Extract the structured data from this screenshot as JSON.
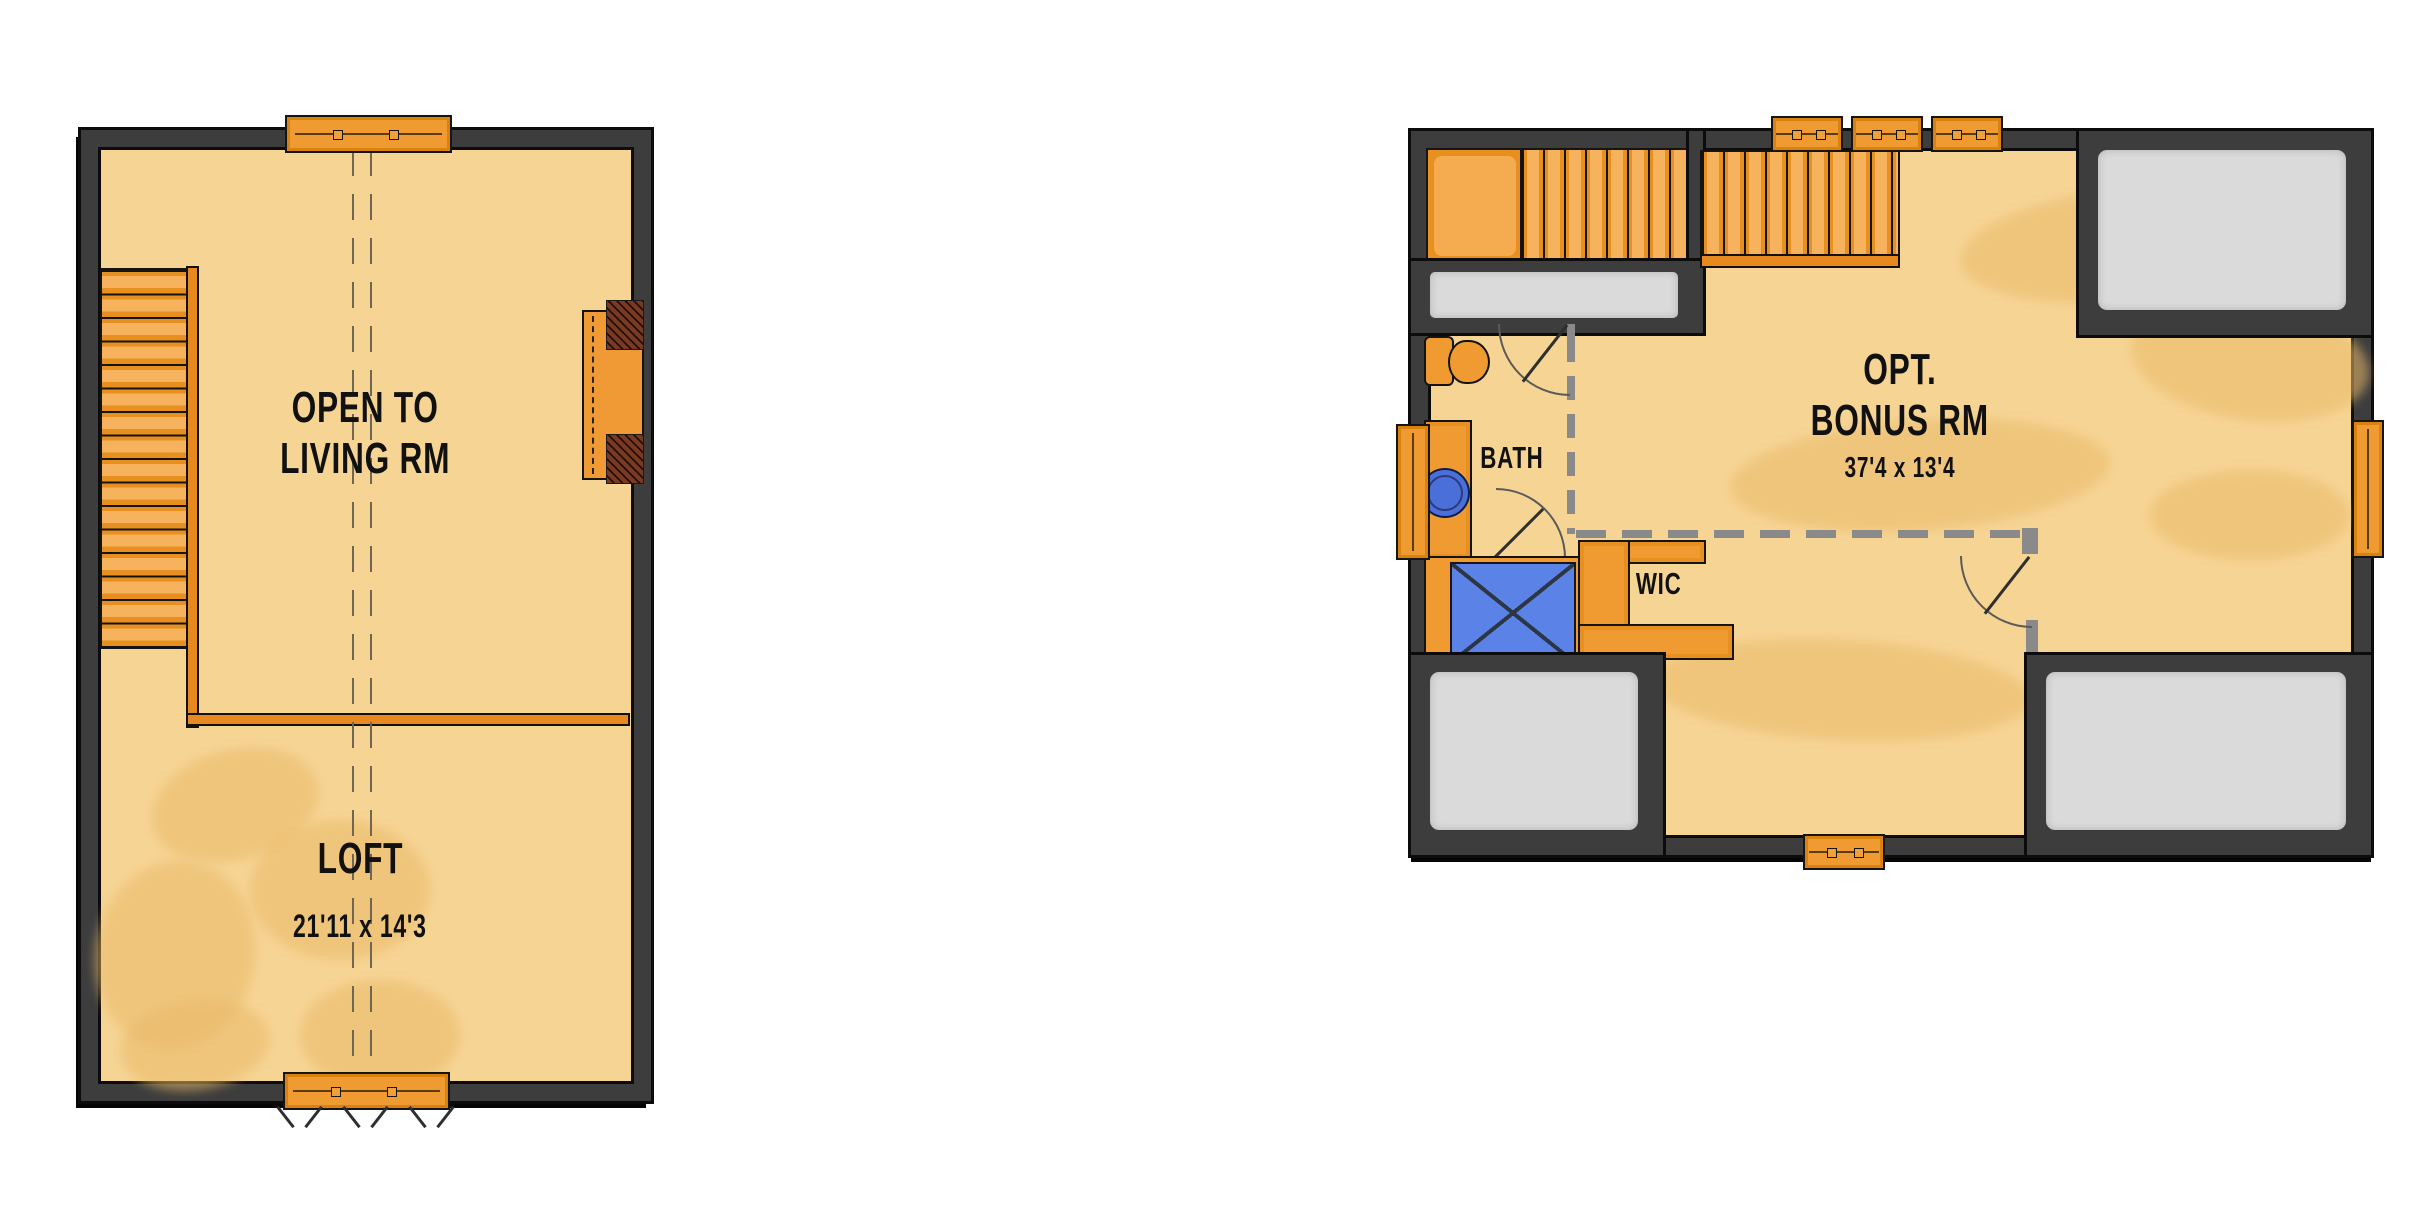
{
  "page": {
    "background": "#ffffff"
  },
  "plans": {
    "loft": {
      "labels": {
        "open_to_line1": "OPEN TO",
        "open_to_line2": "LIVING RM",
        "room": "LOFT",
        "dimensions": "21'11 x 14'3"
      }
    },
    "bonus": {
      "labels": {
        "opt_line1": "OPT.",
        "opt_line2": "BONUS RM",
        "dimensions": "37'4 x 13'4",
        "bath": "BATH",
        "wic": "WIC"
      }
    }
  },
  "icons": {
    "window": "window-icon",
    "door_swing": "door-swing-icon",
    "stairs": "stairs-icon",
    "toilet": "toilet-icon",
    "sink": "sink-icon",
    "shower": "shower-icon"
  },
  "colors": {
    "floor_tan": "#f6d494",
    "floor_texture": "#eaba69",
    "wall_dark": "#3d3d3d",
    "outline_black": "#0c0c0c",
    "interior_wall_gray": "#8a8a8a",
    "attic_gray": "#dadada",
    "wood_orange": "#f09b32",
    "wood_orange_light": "#f6b25c",
    "wood_orange_dark": "#e8891f",
    "shower_blue": "#5b82e6",
    "sink_blue": "#4a6fd8",
    "hatch_red": "#7a3a22",
    "text_black": "#111111"
  }
}
